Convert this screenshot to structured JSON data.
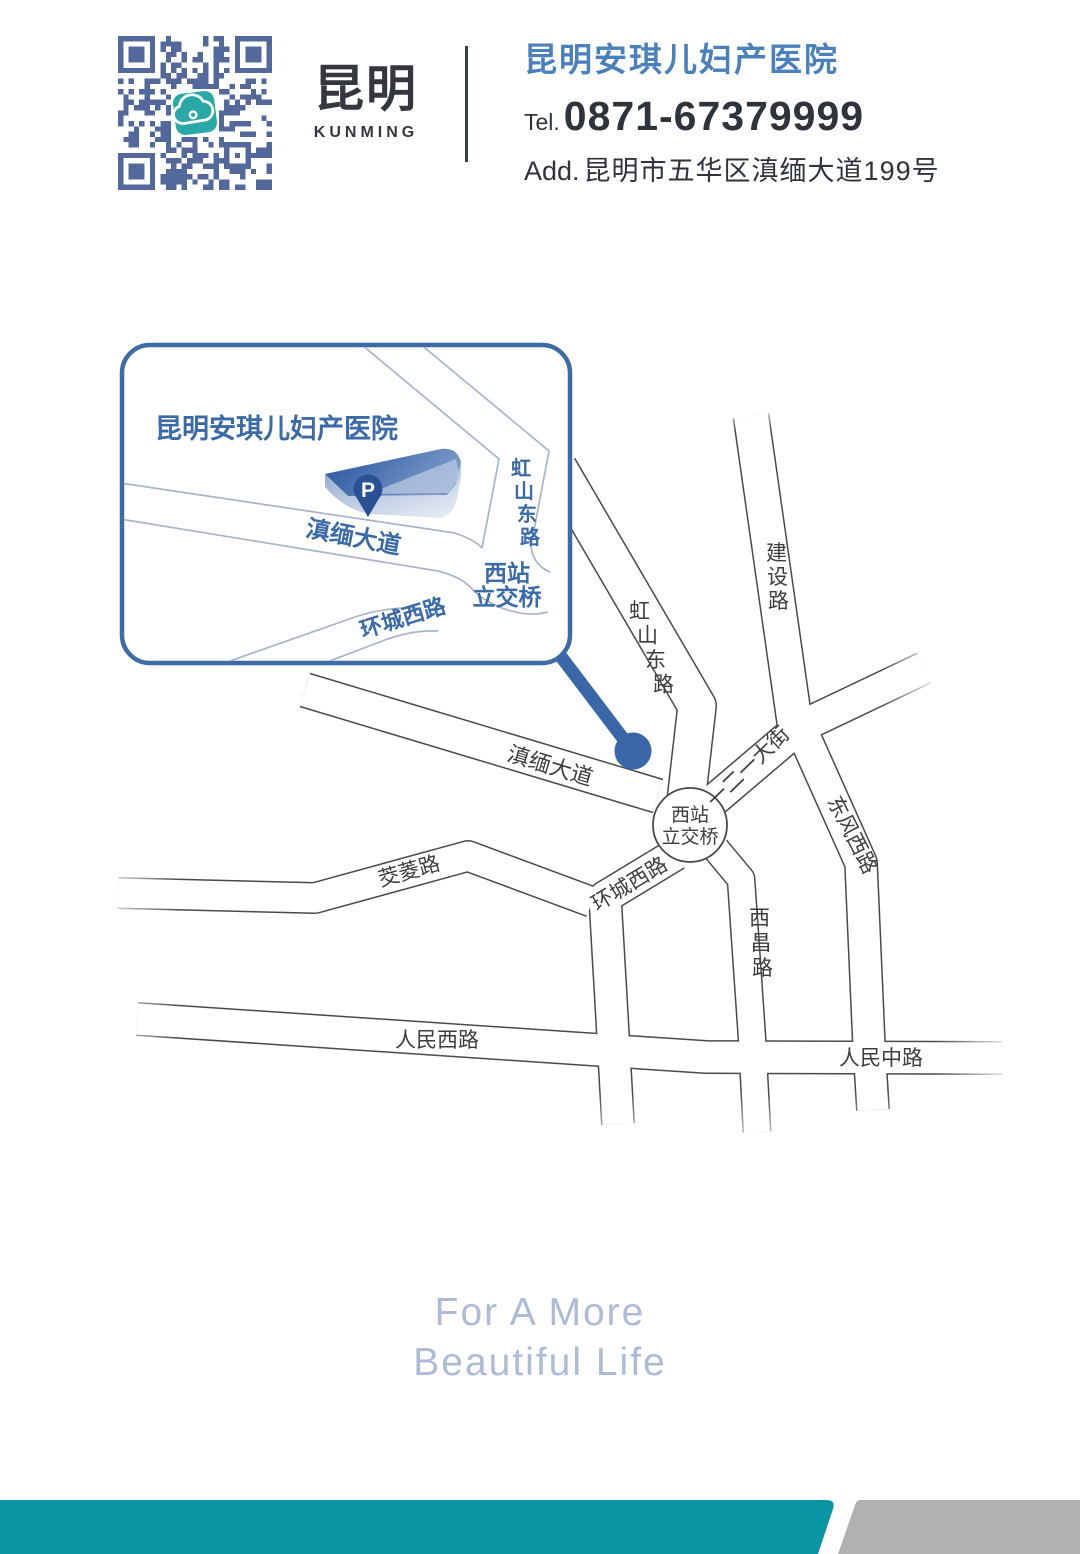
{
  "header": {
    "logo_cn": "昆明",
    "logo_en": "KUNMING",
    "hospital_name": "昆明安琪儿妇产医院",
    "tel_label": "Tel.",
    "tel_number": "0871-67379999",
    "add_label": "Add.",
    "address": "昆明市五华区滇缅大道199号"
  },
  "inset": {
    "title": "昆明安琪儿妇产医院",
    "parking": "P",
    "roads": {
      "dianmian": "滇缅大道",
      "hongshan": "虹山东路",
      "xizhan_line1": "西站",
      "xizhan_line2": "立交桥",
      "huancheng": "环城西路"
    }
  },
  "map": {
    "roads": {
      "hongshan": "虹山东路",
      "jianshe": "建设路",
      "dianmian": "滇缅大道",
      "yieryi": "一二一大街",
      "dongfeng": "东风西路",
      "xizhan_line1": "西站",
      "xizhan_line2": "立交桥",
      "huancheng": "环城西路",
      "jiaoling": "茭菱路",
      "xichang": "西昌路",
      "renmin_west": "人民西路",
      "renmin_middle": "人民中路"
    }
  },
  "footer": {
    "slogan_line1": "For A More",
    "slogan_line2": "Beautiful Life"
  },
  "colors": {
    "brand_blue": "#3a67a8",
    "inset_border_blue": "#3d6ba6",
    "header_name_blue": "#4a80bc",
    "qr_blue": "#53689b",
    "icon_teal": "#28a9a7",
    "accent_teal": "#0b96a6",
    "gray_bar": "#b1b1b1",
    "road_outline": "#4a4a4a",
    "label_dark": "#3d3d3d",
    "slogan_blue": "#aebbd8"
  }
}
